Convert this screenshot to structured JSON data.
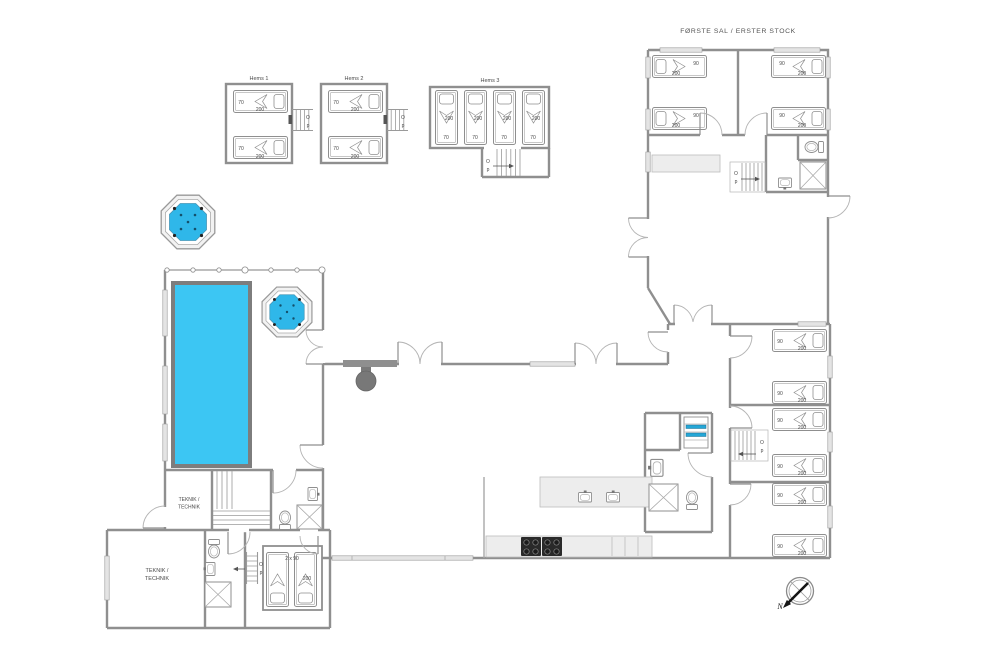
{
  "titles": {
    "first_floor": "FØRSTE SAL / ERSTER STOCK"
  },
  "lofts": {
    "hems1": "Hems 1",
    "hems2": "Hems 2",
    "hems3": "Hems 3"
  },
  "rooms": {
    "technic_line1": "TEKNIK /",
    "technic_line2": "TECHNIK"
  },
  "beds": {
    "w90": "90",
    "w70": "70",
    "l200": "200",
    "double": "2 x 90"
  },
  "stairs": {
    "o": "O",
    "p": "p"
  },
  "compass": {
    "north": "N"
  },
  "colors": {
    "pool": "#3cc6f3",
    "spa_water": "#2fb7e9",
    "wall": "#8f8f8f",
    "shelf_item": "#24a7d7"
  }
}
